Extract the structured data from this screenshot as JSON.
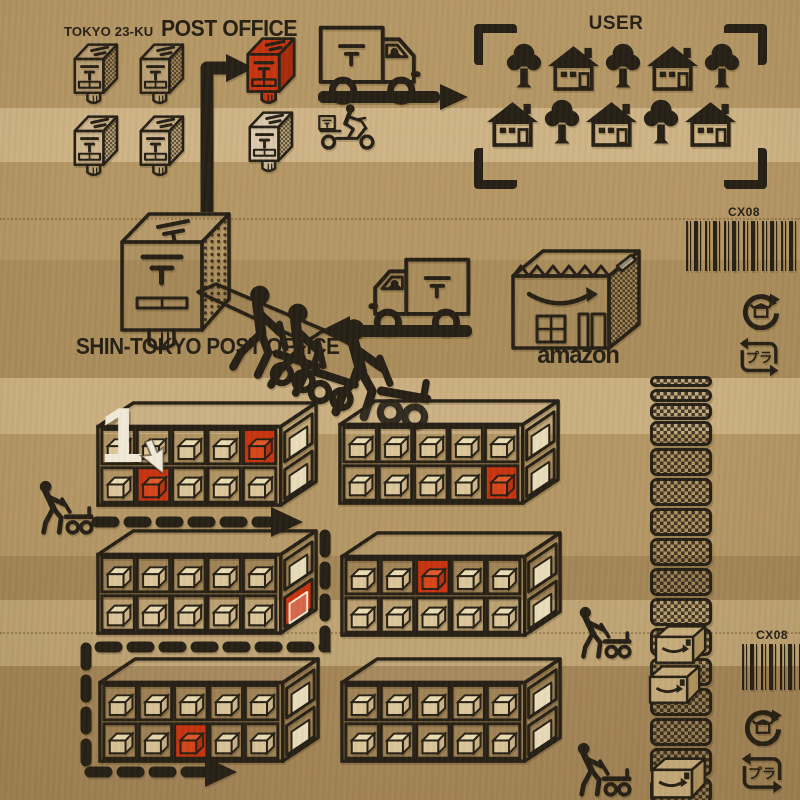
{
  "colors": {
    "red": "#c8340f",
    "ink": "#262015",
    "cream": "#f2ead7",
    "paper": "#b59765"
  },
  "top_flow": {
    "district": "TOKYO 23-KU",
    "title": "POST OFFICE",
    "user_title": "USER",
    "user_rows": [
      [
        "tree",
        "house",
        "tree",
        "house",
        "tree"
      ],
      [
        "house",
        "tree",
        "house",
        "tree",
        "house"
      ]
    ]
  },
  "mid_flow": {
    "shin_label": "SHIN-TOKYO POST OFFICE",
    "amazon_label": "amazon"
  },
  "stickers": {
    "barcode_top": "CX08",
    "barcode_bottom": "CX08",
    "plastic_mark": "プラ"
  },
  "step_marker": "1",
  "shelf_grid": {
    "rows": 2,
    "cols": 5
  },
  "shelf_units": [
    {
      "id": "shelf1",
      "front_red": [
        [
          0,
          4
        ],
        [
          1,
          1
        ]
      ],
      "side_red": []
    },
    {
      "id": "shelf2",
      "front_red": [
        [
          1,
          4
        ]
      ],
      "side_red": []
    },
    {
      "id": "shelf3",
      "front_red": [],
      "side_red": [
        1
      ]
    },
    {
      "id": "shelf4",
      "front_red": [
        [
          0,
          2
        ]
      ],
      "side_red": []
    },
    {
      "id": "shelf5",
      "front_red": [
        [
          1,
          2
        ]
      ],
      "side_red": []
    },
    {
      "id": "shelf6",
      "front_red": [],
      "side_red": []
    }
  ]
}
